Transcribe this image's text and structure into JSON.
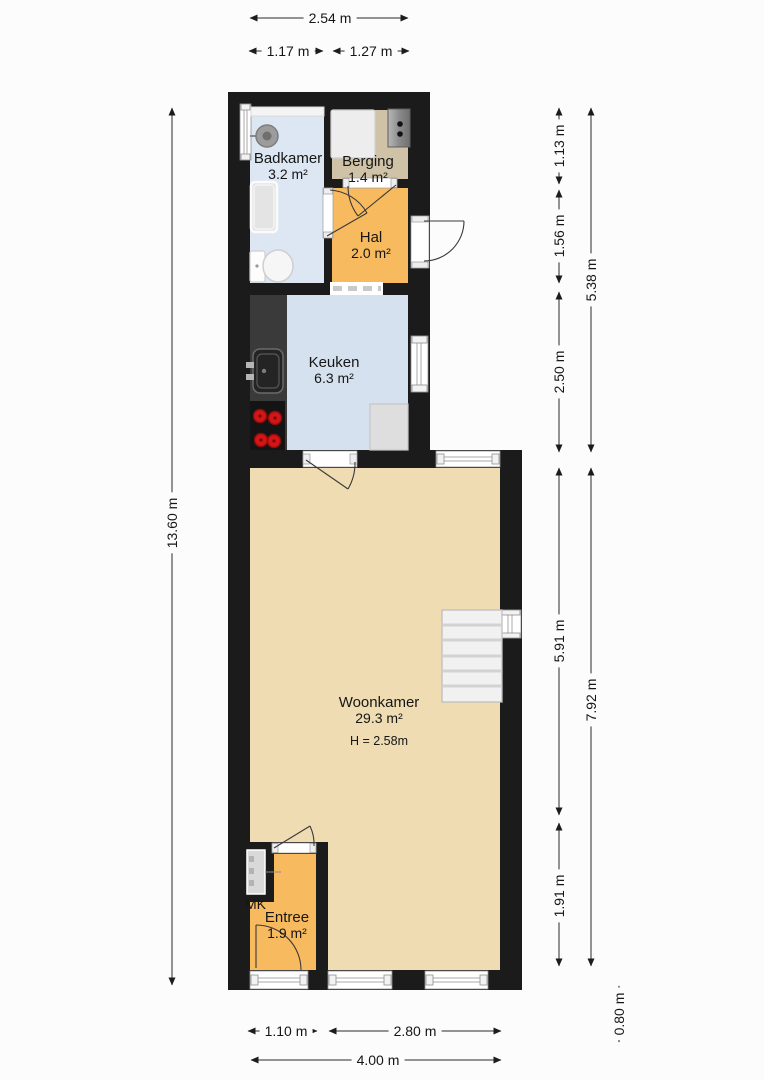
{
  "rooms": {
    "badkamer": {
      "name": "Badkamer",
      "area": "3.2 m²"
    },
    "berging": {
      "name": "Berging",
      "area": "1.4 m²"
    },
    "hal": {
      "name": "Hal",
      "area": "2.0 m²"
    },
    "keuken": {
      "name": "Keuken",
      "area": "6.3 m²"
    },
    "woonkamer": {
      "name": "Woonkamer",
      "area": "29.3 m²",
      "ceiling_height": "H = 2.58m"
    },
    "entree": {
      "name": "Entree",
      "area": "1.9 m²"
    },
    "meterkast": {
      "name": "MK"
    }
  },
  "dimensions": {
    "top_total": "2.54 m",
    "top_left": "1.17 m",
    "top_right": "1.27 m",
    "left_total": "13.60 m",
    "right_badkamer": "1.13 m",
    "right_hal": "1.56 m",
    "right_keuken": "2.50 m",
    "right_upper_total": "5.38 m",
    "right_woonkamer": "5.91 m",
    "right_entree": "1.91 m",
    "right_lower_total": "7.92 m",
    "right_bottom": "0.80 m",
    "bottom_entree": "1.10 m",
    "bottom_woonkamer": "2.80 m",
    "bottom_total": "4.00 m"
  },
  "colors": {
    "wall": "#1b1b1b",
    "bathroom_floor": "#dce7f3",
    "kitchen_floor": "#d5e1ee",
    "storage_floor": "#cfc2a6",
    "hall_floor": "#f7ba5e",
    "entry_floor": "#f7ba5e",
    "living_floor": "#efdcb2",
    "counter_dark": "#3a3a3a",
    "burner_red": "#d31515"
  },
  "fixtures": [
    "wash-basin",
    "shower",
    "toilet",
    "bathroom-shelf",
    "washing-machine",
    "boiler",
    "kitchen-counter",
    "kitchen-sink",
    "stove",
    "worktop",
    "stairs",
    "meter-cabinet"
  ]
}
